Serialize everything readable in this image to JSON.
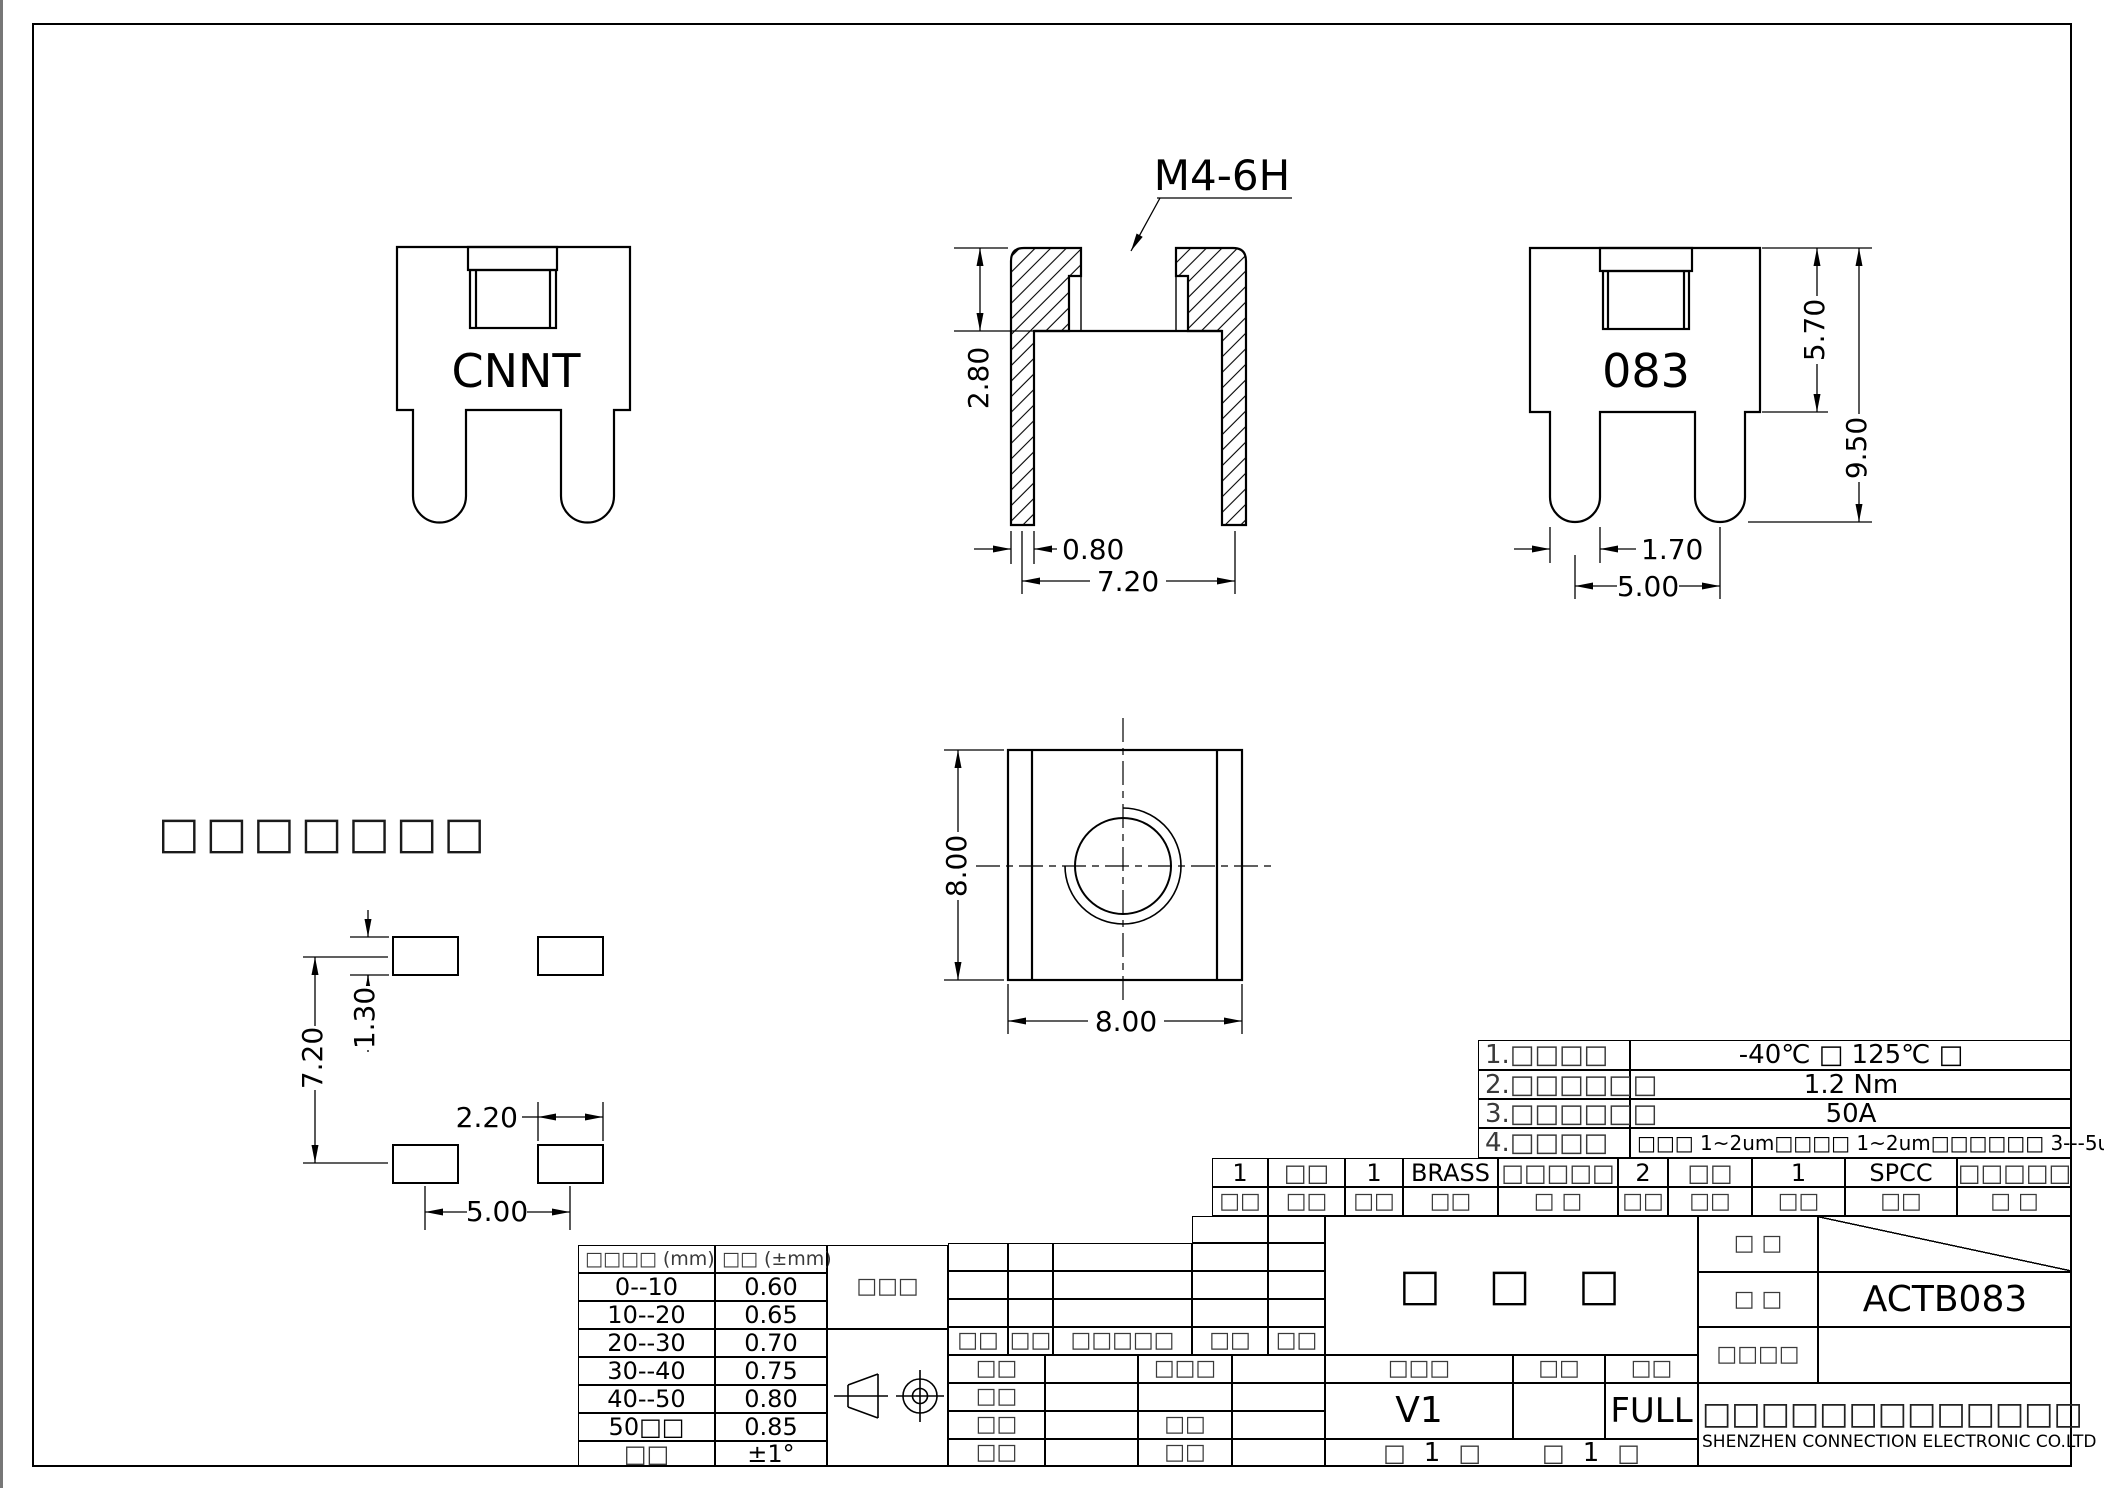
{
  "drawing": {
    "front_view": {
      "label": "CNNT"
    },
    "section_view": {
      "thread": "M4-6H",
      "depth": "2.80",
      "wall": "0.80",
      "inner_width": "7.20"
    },
    "side_view": {
      "label": "083",
      "body_height": "5.70",
      "total_height": "9.50",
      "leg_width": "1.70",
      "leg_pitch": "5.00"
    },
    "top_view": {
      "width": "8.00",
      "height": "8.00"
    },
    "footprint": {
      "pad_height": "1.30",
      "row_pitch": "7.20",
      "pad_width": "2.20",
      "pad_pitch": "5.00"
    },
    "placeholder_note": "□□□□□□□"
  },
  "notes": [
    {
      "label": "1.□□□□",
      "value": "-40℃ □ 125℃ □"
    },
    {
      "label": "2.□□□□□□",
      "value": "1.2 Nm"
    },
    {
      "label": "3.□□□□□□",
      "value": "50A"
    },
    {
      "label": "4.□□□□",
      "value": "□□□  1~2um□□□□  1~2um□□□□□□  3---5um"
    }
  ],
  "bom": {
    "values": [
      "1",
      "□□",
      "1",
      "BRASS",
      "□□□□□",
      "2",
      "□□",
      "1",
      "SPCC",
      "□□□□□"
    ],
    "labels": [
      "□□",
      "□□",
      "□□",
      "□□",
      "□  □",
      "□□",
      "□□",
      "□□",
      "□□",
      "□  □"
    ]
  },
  "revision": {
    "headers": [
      "□□",
      "□□",
      "□□□□□",
      "□□",
      "□□"
    ]
  },
  "signoff": {
    "rows": [
      {
        "c0": "□□",
        "c1": "",
        "c2": "□□□",
        "c3": ""
      },
      {
        "c0": "□□",
        "c1": "",
        "c2": "",
        "c3": ""
      },
      {
        "c0": "□□",
        "c1": "",
        "c2": "□□",
        "c3": ""
      },
      {
        "c0": "□□",
        "c1": "",
        "c2": "□□",
        "c3": ""
      }
    ]
  },
  "tolerance": {
    "col1_header": "□□□□  (mm)",
    "col2_header": "□□ (±mm)",
    "rows": [
      {
        "range": "0--10",
        "tol": "0.60"
      },
      {
        "range": "10--20",
        "tol": "0.65"
      },
      {
        "range": "20--30",
        "tol": "0.70"
      },
      {
        "range": "30--40",
        "tol": "0.75"
      },
      {
        "range": "40--50",
        "tol": "0.80"
      },
      {
        "range": "50□□",
        "tol": "0.85"
      },
      {
        "range": "□□",
        "tol": "±1°"
      }
    ],
    "side_label": "□□□"
  },
  "titleblock": {
    "part_name": "□ □ □",
    "version_header": "□□□",
    "units_header": "□□",
    "scale_header": "□□",
    "version": "V1",
    "scale": "FULL",
    "sheet_info": [
      "□",
      "1",
      "□",
      "□",
      "1",
      "□"
    ],
    "label_row1": "□  □",
    "label_row2": "□  □",
    "label_row3": "□□□□",
    "drawing_number": "ACTB083",
    "company_cn": "□□□□□□□□□□□□□",
    "company_en": "SHENZHEN CONNECTION ELECTRONIC CO.LTD"
  }
}
